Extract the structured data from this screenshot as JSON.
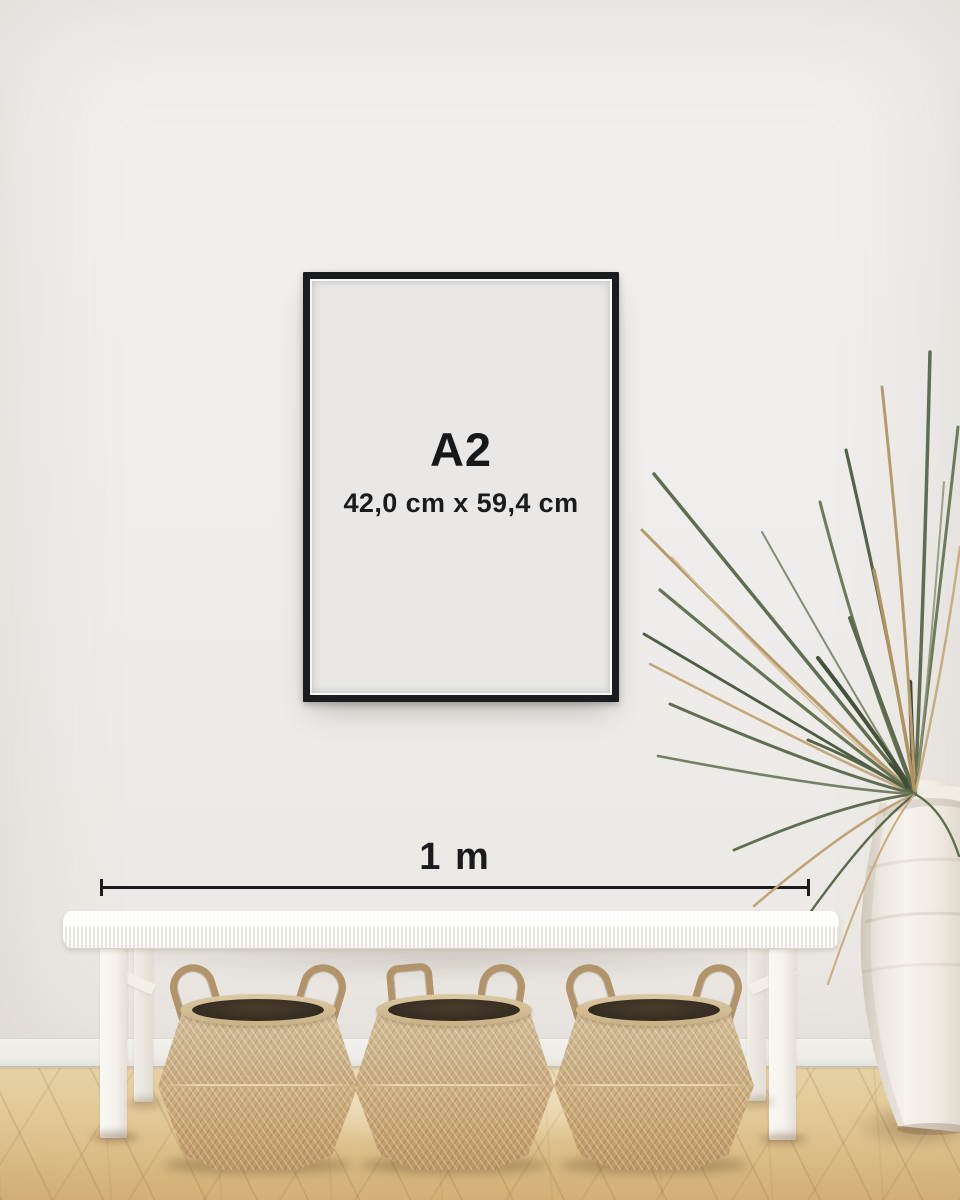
{
  "poster": {
    "size_label": "A2",
    "dimensions_label": "42,0 cm x 59,4 cm"
  },
  "scale_bar": {
    "label": "1 m"
  },
  "scene": {
    "basket_count": 3,
    "colors": {
      "frame": "#1a1c1f",
      "poster_paper": "#e9e8e6",
      "text": "#1b1c1e",
      "wall": "#efeeec",
      "baseboard": "#f0ede8",
      "floor_light": "#e6d2a4",
      "floor_dark": "#d2af77",
      "bench_white": "#f7f5f1",
      "basket_upper": "#ccb389",
      "basket_lower": "#c7a371",
      "basket_rope": "#b2946a",
      "plant_green": "#5f6e50",
      "plant_dried": "#b79a6b",
      "vase_ceramic": "#f3efe8"
    }
  }
}
